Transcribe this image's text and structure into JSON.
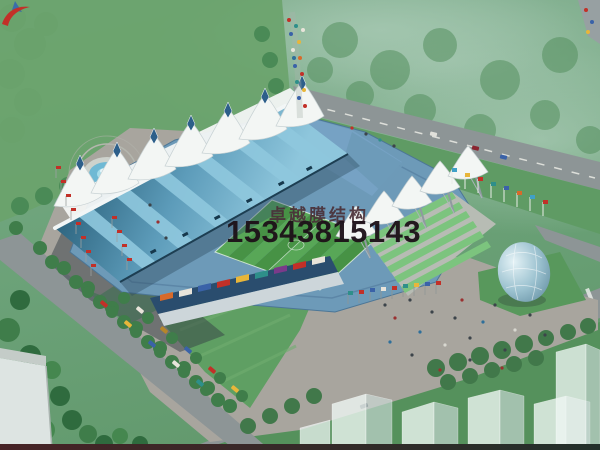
{
  "watermark": {
    "logo_name": "red-swoosh-logo",
    "company_name": "卓越膜结构",
    "phone_number": "15343815143",
    "company_text_color": "#4a3038",
    "phone_text_color": "#1d1118"
  },
  "scene": {
    "type": "aerial-architectural-rendering",
    "subject": "membrane-structure-stadium",
    "elements": [
      "stadium",
      "membrane-roof-tents",
      "football-pitch",
      "blue-grandstand-roof",
      "fountain",
      "plaza",
      "roads",
      "tree-lined-parking",
      "flag-rows",
      "glass-dome",
      "translucent-city-buildings"
    ]
  },
  "colors": {
    "pitch_light": "#58a757",
    "pitch_dark": "#479245",
    "roof_dark": "#245a74",
    "roof_light": "#8ec6dc",
    "membrane_white": "#f3f6f4",
    "seats_blue": "#6d9ab8",
    "plaza_gray": "#a8a59e",
    "road_gray": "#8d9596",
    "grass_green": "#639c6b",
    "terrace_green": "#7cc47e",
    "water_blue": "#6fb9d4"
  }
}
